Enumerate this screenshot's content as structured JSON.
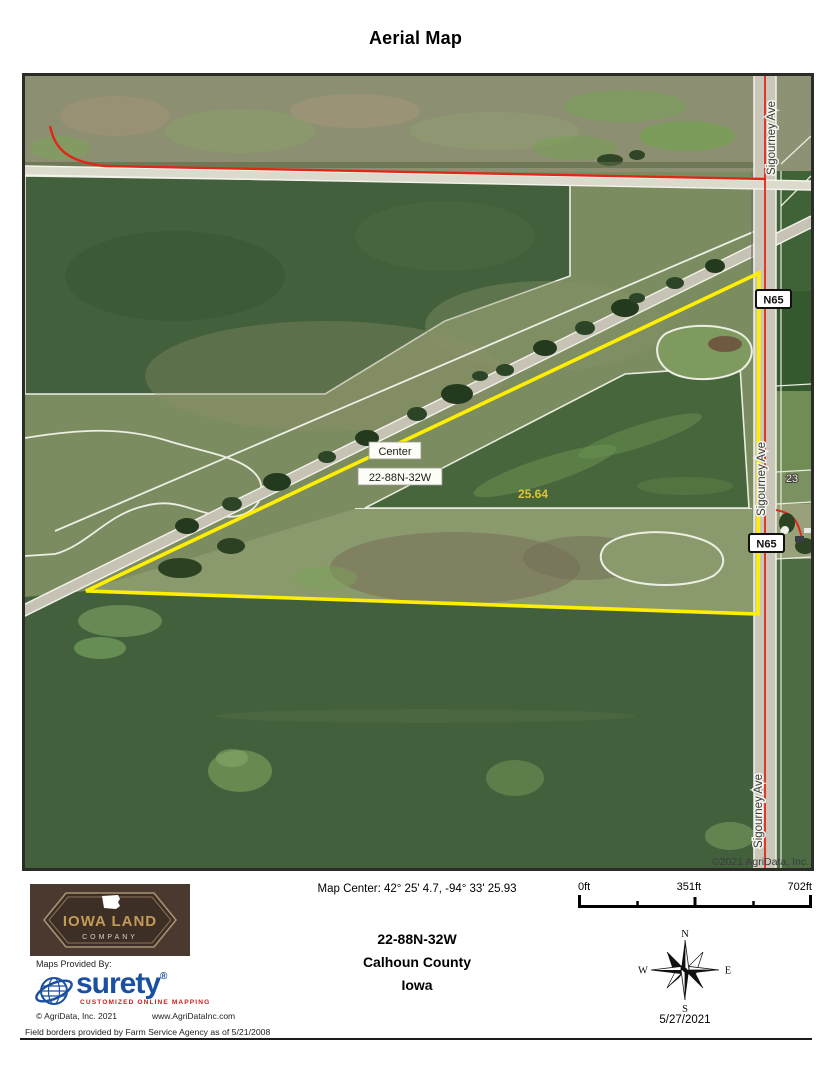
{
  "page": {
    "title": "Aerial Map"
  },
  "map": {
    "labels": {
      "center_marker": "Center",
      "township_marker": "22-88N-32W",
      "acreage": "25.64",
      "road_vertical": "Sigourney Ave",
      "highway_badge": "N65",
      "parcel_number": "23",
      "copyright": "©2021 AgriData, Inc."
    },
    "colors": {
      "parcel_boundary": "#ffee00",
      "highway_line": "#e02818",
      "field_border": "#edeee4",
      "dark_field": "#42603b",
      "road_surface": "#cbc6ba"
    }
  },
  "footer": {
    "iowa_logo": {
      "line1": "IOWA LAND",
      "line2": "COMPANY"
    },
    "maps_provided_by": "Maps Provided By:",
    "surety": {
      "name": "surety",
      "registered": "®",
      "tagline": "CUSTOMIZED ONLINE MAPPING",
      "brand_blue": "#1b4fa0",
      "tagline_red": "#cc2020"
    },
    "agridata_copyright": "© AgriData, Inc. 2021",
    "agridata_url": "www.AgriDataInc.com",
    "field_borders_note": "Field borders provided by Farm Service Agency as of 5/21/2008",
    "map_center": "Map Center: 42° 25' 4.7,  -94° 33' 25.93",
    "township": "22-88N-32W",
    "county": "Calhoun County",
    "state": "Iowa",
    "scale": {
      "start": "0ft",
      "middle": "351ft",
      "end": "702ft"
    },
    "compass": {
      "n": "N",
      "s": "S",
      "e": "E",
      "w": "W"
    },
    "date": "5/27/2021"
  }
}
